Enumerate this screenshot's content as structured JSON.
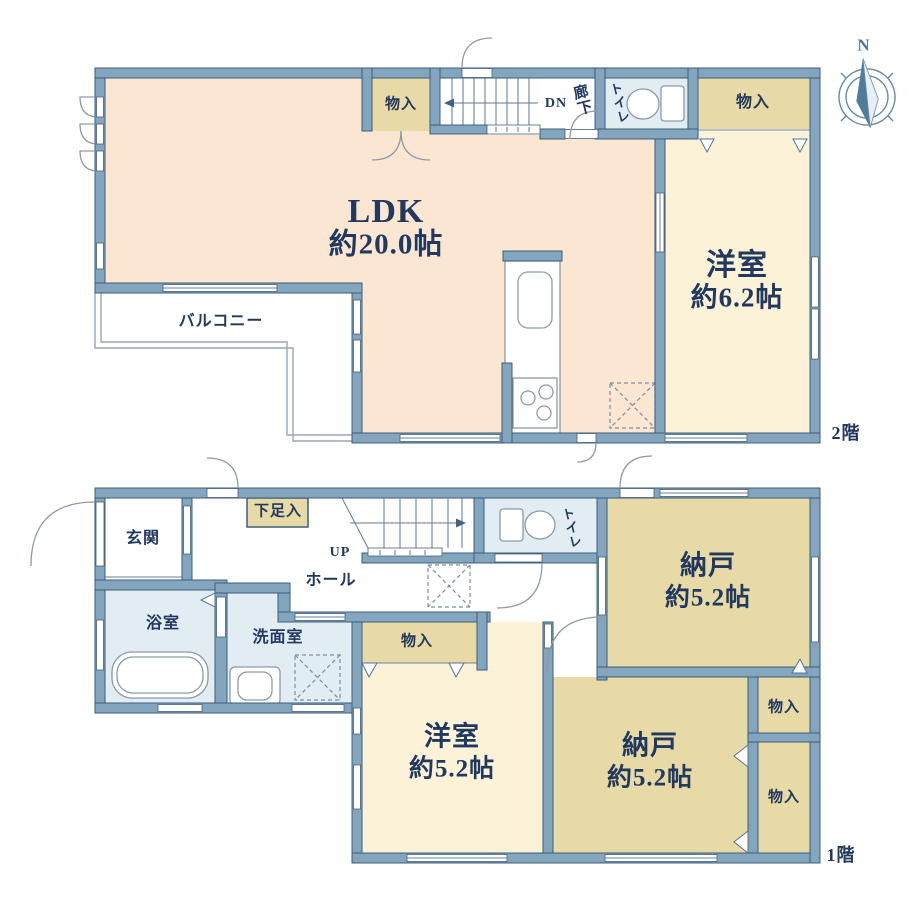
{
  "floor2": {
    "floor_label": "2階",
    "rooms": {
      "ldk": {
        "name": "LDK",
        "size": "約20.0帖"
      },
      "western_room": {
        "name": "洋室",
        "size": "約6.2帖"
      },
      "balcony": {
        "name": "バルコニー"
      },
      "toilet": {
        "name": "トイレ"
      },
      "corridor": {
        "name": "廊下"
      },
      "closet_left": {
        "name": "物入"
      },
      "closet_right": {
        "name": "物入"
      }
    },
    "stairs": {
      "direction_label": "DN"
    }
  },
  "floor1": {
    "floor_label": "1階",
    "rooms": {
      "entrance": {
        "name": "玄関"
      },
      "shoe_closet": {
        "name": "下足入"
      },
      "hall": {
        "name": "ホール"
      },
      "bathroom": {
        "name": "浴室"
      },
      "washroom": {
        "name": "洗面室"
      },
      "toilet": {
        "name": "トイレ"
      },
      "storage_room_top": {
        "name": "納戸",
        "size": "約5.2帖"
      },
      "storage_room_bottom": {
        "name": "納戸",
        "size": "約5.2帖"
      },
      "western_room": {
        "name": "洋室",
        "size": "約5.2帖"
      },
      "closet_west": {
        "name": "物入"
      },
      "closet_east_top": {
        "name": "物入"
      },
      "closet_east_bottom": {
        "name": "物入"
      }
    },
    "stairs": {
      "direction_label": "UP"
    }
  },
  "compass": {
    "north_label": "N"
  },
  "colors": {
    "wall": "#83a6be",
    "ldk_floor": "#fbe6d1",
    "room_floor": "#fcf2d8",
    "closet_floor": "#e8daa6",
    "wet_floor": "#e2ecf3",
    "text": "#21385f",
    "compass": "#50779a"
  }
}
